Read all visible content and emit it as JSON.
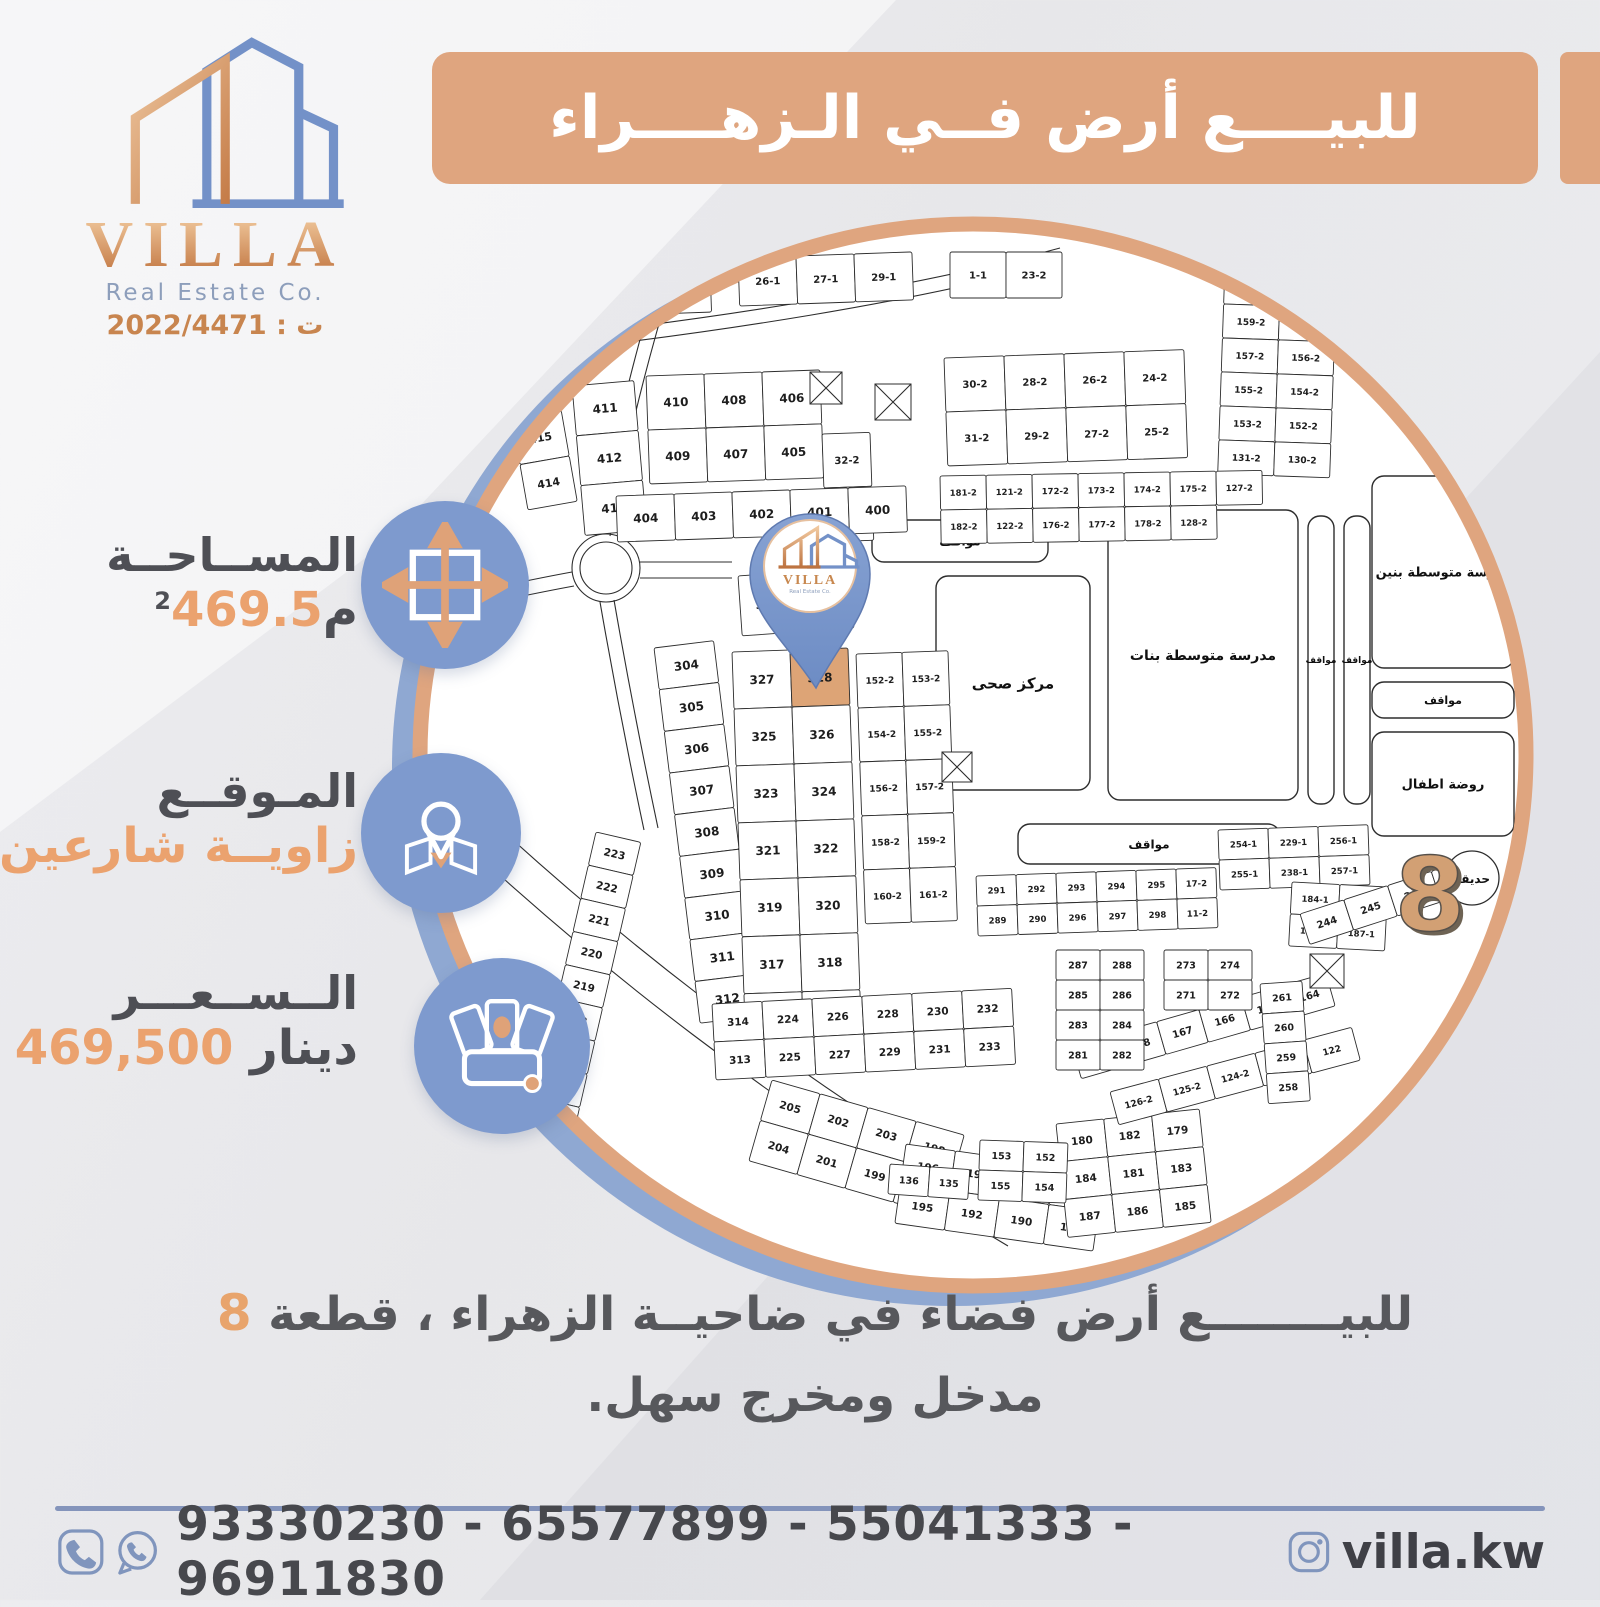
{
  "logo": {
    "name": "VILLA",
    "subtitle": "Real Estate Co.",
    "license": "ت : 2022/4471"
  },
  "banner": {
    "title": "للبيــــع أرض فــي الـزهــــراء"
  },
  "info": [
    {
      "id": "area",
      "label": "المســاحــة",
      "value_number": "469.5",
      "value_unit": "م",
      "value_sup": "2"
    },
    {
      "id": "location",
      "label": "المـوقــع",
      "value": "زاويــة شارعين"
    },
    {
      "id": "price",
      "label": "الــســعـــر",
      "value_number": "469,500",
      "value_unit": "دينار"
    }
  ],
  "description": {
    "line1_prefix": "للبيــــــــع أرض فضاء في ضاحيــة الزهراء ، قطعة",
    "line1_number": "8",
    "line2": "مدخل ومخرج سهل."
  },
  "footer": {
    "phones": "93330230 - 65577899 - 55041333 - 96911830",
    "instagram": "villa.kw"
  },
  "map": {
    "district_number": "8",
    "garden_label": "حديقة",
    "highlight_plot": "328",
    "pin": {
      "brand": "VILLA",
      "sub": "Real Estate Co."
    },
    "areas": [
      {
        "id": "parkA",
        "label": "مواقف"
      },
      {
        "id": "hc",
        "label": "مركز صحى"
      },
      {
        "id": "girls",
        "label": "مدرسة متوسطة بنات"
      },
      {
        "id": "pv1",
        "label": "مواقف"
      },
      {
        "id": "pv2",
        "label": "مواقف"
      },
      {
        "id": "boys",
        "label": "مدرسة متوسطة بنين"
      },
      {
        "id": "parkB",
        "label": "مواقف"
      },
      {
        "id": "kg",
        "label": "روضة اطفال"
      },
      {
        "id": "parkC",
        "label": "مواقف"
      }
    ],
    "grids": [
      {
        "id": "topsmall1",
        "rows": [
          [
            "19-1",
            "20-1"
          ]
        ]
      },
      {
        "id": "topsmall2",
        "rows": [
          [
            "26-1",
            "27-1",
            "29-1"
          ]
        ]
      },
      {
        "id": "topsmall3",
        "rows": [
          [
            "1-1",
            "23-2"
          ]
        ]
      },
      {
        "id": "topright",
        "rows": [
          [
            "163-2",
            "162-2"
          ],
          [
            "161-2",
            "160-2"
          ],
          [
            "159-2",
            "158-2"
          ],
          [
            "157-2",
            "156-2"
          ],
          [
            "155-2",
            "154-2"
          ],
          [
            "153-2",
            "152-2"
          ],
          [
            "131-2",
            "130-2"
          ]
        ]
      },
      {
        "id": "col41xOuter",
        "rows": [
          [
            "416"
          ],
          [
            "415"
          ],
          [
            "414"
          ]
        ]
      },
      {
        "id": "col41x",
        "rows": [
          [
            "411"
          ],
          [
            "412"
          ],
          [
            "413"
          ]
        ]
      },
      {
        "id": "g400s",
        "rows": [
          [
            "410",
            "408",
            "406"
          ],
          [
            "409",
            "407",
            "405"
          ]
        ]
      },
      {
        "id": "col3x2",
        "rows": [
          [
            "32-2"
          ],
          [
            "33-2"
          ]
        ]
      },
      {
        "id": "g2series",
        "rows": [
          [
            "30-2",
            "28-2",
            "26-2",
            "24-2"
          ],
          [
            "31-2",
            "29-2",
            "27-2",
            "25-2"
          ]
        ]
      },
      {
        "id": "g174strip",
        "rows": [
          [
            "181-2",
            "121-2",
            "172-2",
            "173-2",
            "174-2",
            "175-2",
            "127-2"
          ],
          [
            "182-2",
            "122-2",
            "176-2",
            "177-2",
            "178-2",
            "128-2"
          ]
        ]
      },
      {
        "id": "g400row",
        "rows": [
          [
            "404",
            "403",
            "402",
            "401",
            "400"
          ]
        ]
      },
      {
        "id": "g303",
        "rows": [
          [
            "303",
            "302"
          ]
        ]
      },
      {
        "id": "colLeft",
        "rows": [
          [
            "304"
          ],
          [
            "305"
          ],
          [
            "306"
          ],
          [
            "307"
          ],
          [
            "308"
          ],
          [
            "309"
          ],
          [
            "310"
          ],
          [
            "311"
          ],
          [
            "312"
          ]
        ]
      },
      {
        "id": "pinBlock",
        "rows": [
          [
            "327",
            "328"
          ],
          [
            "325",
            "326"
          ],
          [
            "323",
            "324"
          ],
          [
            "321",
            "322"
          ],
          [
            "319",
            "320"
          ],
          [
            "317",
            "318"
          ],
          [
            "315",
            "316"
          ]
        ]
      },
      {
        "id": "stripRight",
        "rows": [
          [
            "152-2",
            "153-2"
          ],
          [
            "154-2",
            "155-2"
          ],
          [
            "156-2",
            "157-2"
          ],
          [
            "158-2",
            "159-2"
          ],
          [
            "160-2",
            "161-2"
          ]
        ]
      },
      {
        "id": "g2912",
        "rows": [
          [
            "291",
            "292",
            "293",
            "294",
            "295",
            "17-2"
          ],
          [
            "289",
            "290",
            "296",
            "297",
            "298",
            "11-2"
          ]
        ]
      },
      {
        "id": "g254",
        "rows": [
          [
            "254-1",
            "229-1",
            "256-1"
          ],
          [
            "255-1",
            "238-1",
            "257-1"
          ]
        ]
      },
      {
        "id": "g184",
        "rows": [
          [
            "184-1",
            "185-1"
          ],
          [
            "186-1",
            "187-1"
          ]
        ]
      },
      {
        "id": "arc213",
        "rows": [
          [
            "223"
          ],
          [
            "222"
          ],
          [
            "221"
          ],
          [
            "220"
          ],
          [
            "219"
          ],
          [
            "218"
          ],
          [
            "217"
          ],
          [
            "216"
          ],
          [
            "215"
          ],
          [
            "214"
          ]
        ]
      },
      {
        "id": "g313strip",
        "rows": [
          [
            "314",
            "224",
            "226",
            "228",
            "230",
            "232"
          ],
          [
            "313",
            "225",
            "227",
            "229",
            "231",
            "233"
          ]
        ]
      },
      {
        "id": "fan1",
        "rows": [
          [
            "205",
            "202",
            "203",
            "198"
          ],
          [
            "204",
            "201",
            "199",
            "197"
          ]
        ]
      },
      {
        "id": "fan2",
        "rows": [
          [
            "196",
            "193",
            "191",
            "189"
          ],
          [
            "195",
            "192",
            "190",
            "188"
          ]
        ]
      },
      {
        "id": "fan3",
        "rows": [
          [
            "180",
            "182",
            "179"
          ],
          [
            "184",
            "181",
            "183"
          ],
          [
            "187",
            "186",
            "185"
          ]
        ]
      },
      {
        "id": "g169",
        "rows": [
          [
            "169",
            "168",
            "167",
            "166",
            "165",
            "164"
          ]
        ]
      },
      {
        "id": "g244",
        "rows": [
          [
            "244",
            "245",
            "246",
            "247"
          ]
        ]
      },
      {
        "id": "g123",
        "rows": [
          [
            "126-2",
            "125-2",
            "124-2",
            "123-2",
            "122"
          ]
        ]
      },
      {
        "id": "g287",
        "rows": [
          [
            "287",
            "288"
          ],
          [
            "285",
            "286"
          ],
          [
            "283",
            "284"
          ],
          [
            "281",
            "282"
          ]
        ]
      },
      {
        "id": "g273",
        "rows": [
          [
            "273",
            "274"
          ],
          [
            "271",
            "272"
          ]
        ]
      },
      {
        "id": "col261",
        "rows": [
          [
            "261"
          ],
          [
            "260"
          ],
          [
            "259"
          ],
          [
            "258"
          ]
        ]
      },
      {
        "id": "g153",
        "rows": [
          [
            "153",
            "152"
          ],
          [
            "155",
            "154"
          ]
        ]
      },
      {
        "id": "g136",
        "rows": [
          [
            "136",
            "135"
          ]
        ]
      }
    ]
  }
}
